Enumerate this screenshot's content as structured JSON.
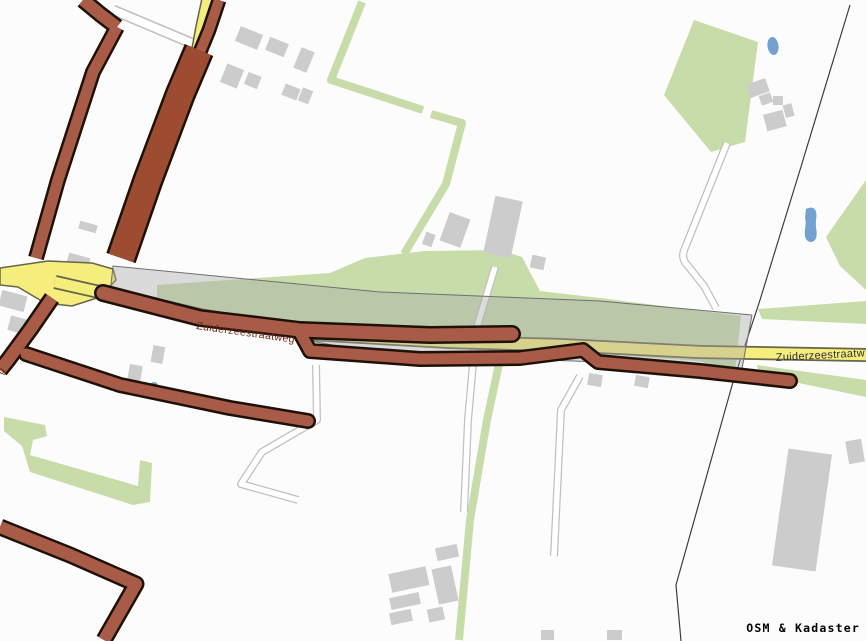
{
  "map": {
    "labels": {
      "road_west": "Zuiderzeestraatweg",
      "road_east": "Zuiderzeestraatw",
      "road_fragment_left": "g"
    },
    "attribution": "OSM & Kadaster",
    "features": {
      "highlighted_route": "brown route overlay along Zuiderzeestraatweg and side streets",
      "study_corridor": "semi-transparent gray band across the map",
      "roundabout": "yellow junction at left",
      "water": "small ponds",
      "land": "green fields and hedgerows, gray buildings"
    }
  },
  "colors": {
    "bg": "#fcfcfc",
    "green": "#c8dcaa",
    "building": "#cccccc",
    "path_casing": "#c0c0c0",
    "path_fill": "#ffffff",
    "water": "#74a1d2",
    "boundary": "#3c3c3c",
    "road_yellow": "#f5ee7d",
    "yellow_casing": "#65654a",
    "junction_island": "#f4f0d8",
    "band_fill": "#a8a8a8",
    "band_stroke": "#6f6f6f",
    "route_brown": "#a85c48",
    "route_dark": "#9e4c31",
    "route_casing": "#1e1107",
    "label_red": "#6e2517",
    "label_dark": "#2e2e2e",
    "attribution_color": "#000000"
  }
}
